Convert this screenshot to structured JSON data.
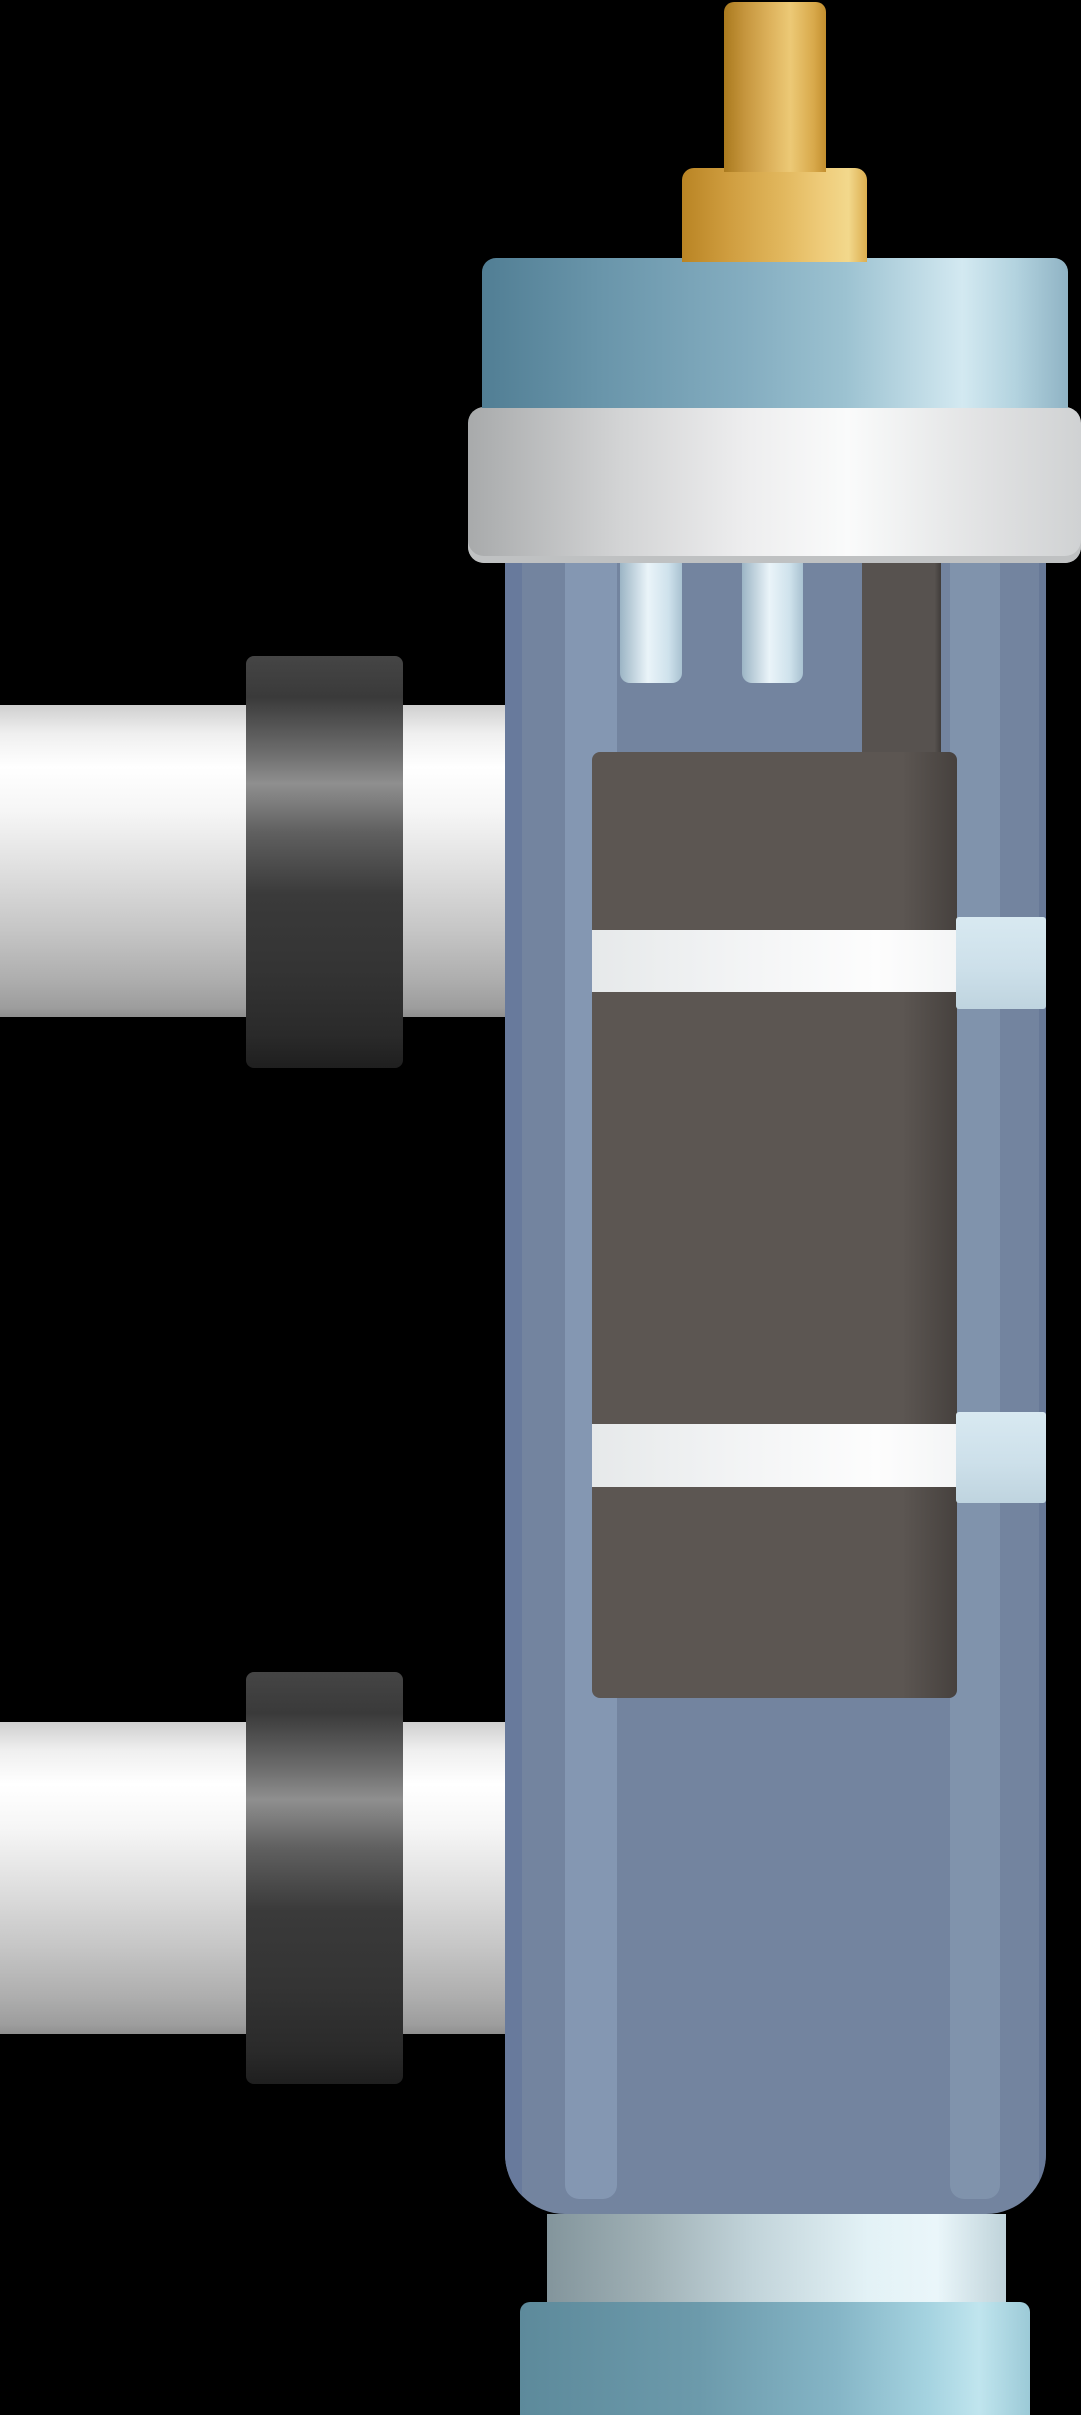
{
  "description": "Flat vector illustration of a vertical cylindrical water filter / UV sterilizer unit: blue-grey vessel with a dark front panel crossed by two white bands, brass stem fitting on a light-blue lid with a silver flange, two white side pipes with black couplings on the left, and a metallic neck with a light-blue base cap at the bottom, on a black background.",
  "parts": {
    "brass_stem": "brass stem",
    "brass_base": "brass stem base",
    "lid": "light blue lid",
    "flange": "silver flange ring",
    "vessel": "blue vessel body",
    "front_panel": "dark front panel",
    "panel_band_upper": "upper white band",
    "panel_band_lower": "lower white band",
    "side_tab_upper": "upper clear clip",
    "side_tab_lower": "lower clear clip",
    "drain_tubes": "two inner tubes under flange",
    "upper_port": "upper side pipe with black coupling",
    "lower_port": "lower side pipe with black coupling",
    "neck": "metallic neck ring",
    "base_cap": "light blue base cap"
  },
  "colors": {
    "background": "#000000",
    "gold_dark": "#aa7a1e",
    "gold_bright": "#ecc976",
    "gold_mid": "#d8a94b",
    "gold_edge": "#c38f2f",
    "goldb_dark": "#b98424",
    "goldb_bright": "#eecb79",
    "goldb_sheen": "#f2d88c",
    "goldb_edge": "#dcae4f",
    "lid_dark": "#517e94",
    "lid_mid": "#84adc0",
    "lid_bright": "#d3e9f1",
    "lid_edge": "#8fb3c4",
    "flange_dark": "#a8aaab",
    "flange_bright": "#fafbfb",
    "flange_shadow": "#d0d2d3",
    "flange_lip": "#bfc1c2",
    "body_base": "#73849f",
    "body_edge_left": "#687a9c",
    "body_highlight": "#8497b2",
    "body_strip_right": "#8093ac",
    "body_edge_right": "#5f7190",
    "panel_dark": "#5c5652",
    "panel_edge": "#46413e",
    "strip_dark": "#57524f",
    "strip_dark_edge": "#403c3a",
    "band_left": "#e6e9ea",
    "band_mid": "#f4f5f6",
    "band_bright": "#fdfdfd",
    "tab_light": "#d8e9f1",
    "tab_mid": "#cde0ea",
    "tab_shade": "#bfd4df",
    "tube_edge": "#9cb5c5",
    "tube_light": "#eaf4f9",
    "tube_mid": "#cfe2ec",
    "tube_shade": "#a9c2d1",
    "pipe_top": "#cfcfcf",
    "pipe_light": "#ffffff",
    "pipe_mid": "#e0e0e0",
    "pipe_shade": "#c6c6c6",
    "pipe_dark": "#9d9d9d",
    "pipe_edge": "#8f8f8f",
    "collar_top": "#454545",
    "collar_light": "#8f8f8f",
    "collar_mid": "#3a3a3a",
    "collar_dark": "#2a2a2a",
    "collar_edge": "#1f1f1f",
    "neck_dark": "#83959c",
    "neck_mid": "#c2d4da",
    "neck_light": "#e3f2f6",
    "neck_bright": "#eaf6fa",
    "neck_edge": "#bfd3da",
    "basecap_dark": "#5d8a9b",
    "basecap_mid": "#85b5c6",
    "basecap_bright": "#c0e5ee",
    "basecap_edge": "#9ccad7"
  }
}
